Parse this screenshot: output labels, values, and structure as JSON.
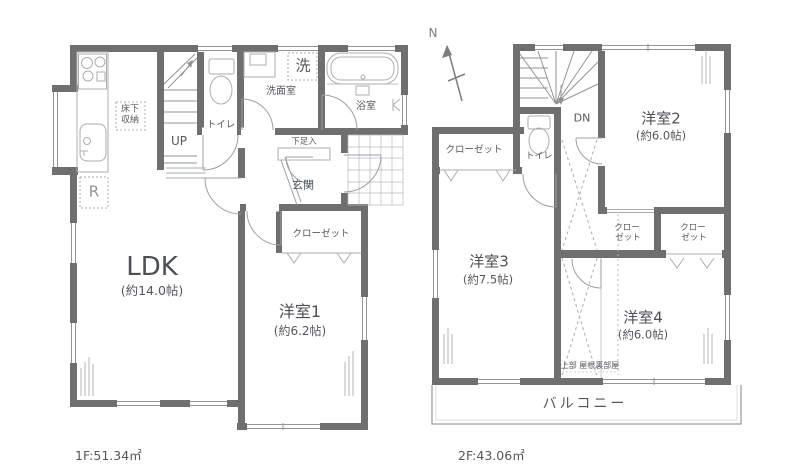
{
  "meta": {
    "type": "floor-plan",
    "floors_count": 2
  },
  "colors": {
    "wall": "#6f6f6f",
    "thin_line": "#9aa0a4",
    "fixture_line": "#a9aeb2",
    "text": "#54585d"
  },
  "floor1": {
    "area": "1F:51.34㎡",
    "ldk": {
      "name": "LDK",
      "size": "(約14.0帖)"
    },
    "room1": {
      "name": "洋室1",
      "size": "(約6.2帖)"
    },
    "labels": {
      "closet": "クローゼット",
      "genkan": "玄関",
      "getabako": "下足入",
      "bath": "浴室",
      "washroom": "洗面室",
      "laundry": "洗",
      "toilet": "トイレ",
      "up": "UP",
      "floor_storage1": "床下",
      "floor_storage2": "収納",
      "fridge": "R"
    }
  },
  "floor2": {
    "area": "2F:43.06㎡",
    "north": "N",
    "dn": "DN",
    "toilet": "トイレ",
    "closet": "クローゼット",
    "closet_line1": "クロー",
    "closet_line2": "ゼット",
    "room2": {
      "name": "洋室2",
      "size": "(約6.0帖)"
    },
    "room3": {
      "name": "洋室3",
      "size": "(約7.5帖)"
    },
    "room4": {
      "name": "洋室4",
      "size": "(約6.0帖)"
    },
    "attic": "上部 屋根裏部屋",
    "balcony": "バルコニー"
  }
}
